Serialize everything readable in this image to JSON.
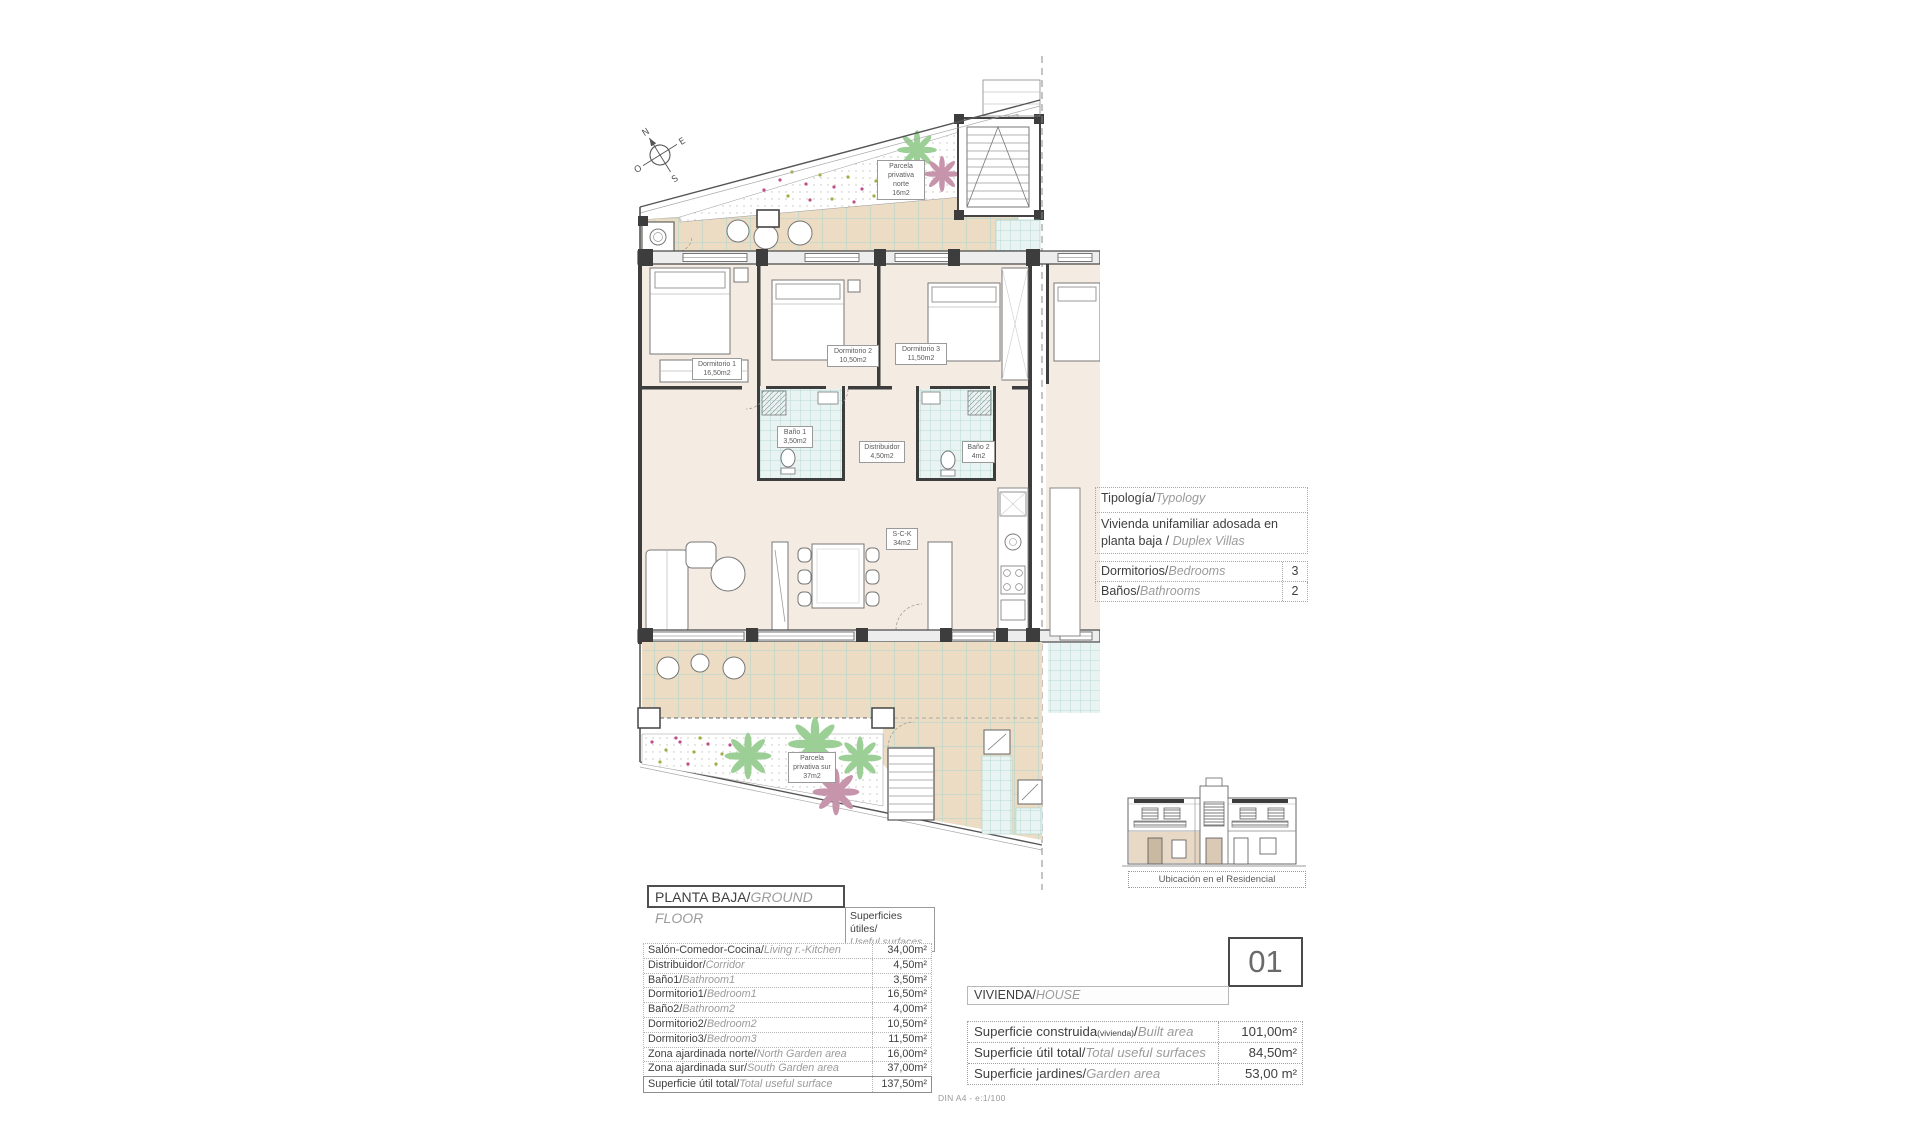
{
  "compass": {
    "n": "N",
    "e": "E",
    "s": "S",
    "o": "O"
  },
  "plan_labels": {
    "parcela_norte": [
      "Parcela",
      "privativa norte",
      "16m2"
    ],
    "parcela_sur": [
      "Parcela",
      "privativa sur",
      "37m2"
    ],
    "dormitorio1": [
      "Dormitorio 1",
      "16,50m2"
    ],
    "dormitorio2": [
      "Dormitorio 2",
      "10,50m2"
    ],
    "dormitorio3": [
      "Dormitorio 3",
      "11,50m2"
    ],
    "bano1": [
      "Baño 1",
      "3,50m2"
    ],
    "bano2": [
      "Baño 2",
      "4m2"
    ],
    "distribuidor": [
      "Distribuidor",
      "4,50m2"
    ],
    "sck": [
      "S-C-K",
      "34m2"
    ]
  },
  "typology": {
    "header_es": "Tipología/",
    "header_en": "Typology",
    "line1": "Vivienda unifamiliar adosada en",
    "line2_es": "planta baja / ",
    "line2_en": "Duplex Villas"
  },
  "rooms_summary": [
    {
      "es": "Dormitorios/",
      "en": "Bedrooms",
      "value": "3"
    },
    {
      "es": "Baños/",
      "en": "Bathrooms",
      "value": "2"
    }
  ],
  "location_caption": "Ubicación en el Residencial",
  "floor_title": {
    "es": "PLANTA BAJA/",
    "en": "GROUND FLOOR"
  },
  "surfaces_header": {
    "es": "Superficies útiles/",
    "en": "Useful surfaces"
  },
  "surfaces_table": {
    "rows": [
      {
        "es": "Salón-Comedor-Cocina/",
        "en": "Living r.-Kitchen",
        "value": "34,00m²"
      },
      {
        "es": "Distribuidor/",
        "en": "Corridor",
        "value": "4,50m²"
      },
      {
        "es": "Baño1/",
        "en": "Bathroom1",
        "value": "3,50m²"
      },
      {
        "es": "Dormitorio1/",
        "en": "Bedroom1",
        "value": "16,50m²"
      },
      {
        "es": "Baño2/",
        "en": "Bathroom2",
        "value": "4,00m²"
      },
      {
        "es": "Dormitorio2/",
        "en": "Bedroom2",
        "value": "10,50m²"
      },
      {
        "es": "Dormitorio3/",
        "en": "Bedroom3",
        "value": "11,50m²"
      },
      {
        "es": "Zona ajardinada norte/",
        "en": "North Garden area",
        "value": "16,00m²"
      },
      {
        "es": "Zona ajardinada sur/",
        "en": "South Garden area",
        "value": "37,00m²"
      },
      {
        "es": "Superficie útil total/",
        "en": "Total useful surface",
        "value": "137,50m²"
      }
    ]
  },
  "house": {
    "es": "VIVIENDA/",
    "en": "HOUSE",
    "number": "01"
  },
  "house_table": {
    "rows": [
      {
        "es": "Superficie construida",
        "paren": "(vivienda)",
        "slash": "/",
        "en": "Built area",
        "value": "101,00m²"
      },
      {
        "es": "Superficie útil total",
        "slash": "/",
        "en": "Total useful surfaces",
        "value": "84,50m²"
      },
      {
        "es": "Superficie jardines",
        "slash": "/",
        "en": "Garden area",
        "value": "53,00 m²"
      }
    ]
  },
  "footer": "DIN A4 - e:1/100",
  "colors": {
    "room_fill": "#f4ebe2",
    "tile_fill": "#ecdcc3",
    "tile_grout": "#b8d6ce",
    "teal_tile": "#a8d3cc",
    "palm_green": "#9ccf95",
    "palm_pink": "#c795ab",
    "flower_pink": "#bf4f88",
    "flower_green": "#9fae45"
  }
}
